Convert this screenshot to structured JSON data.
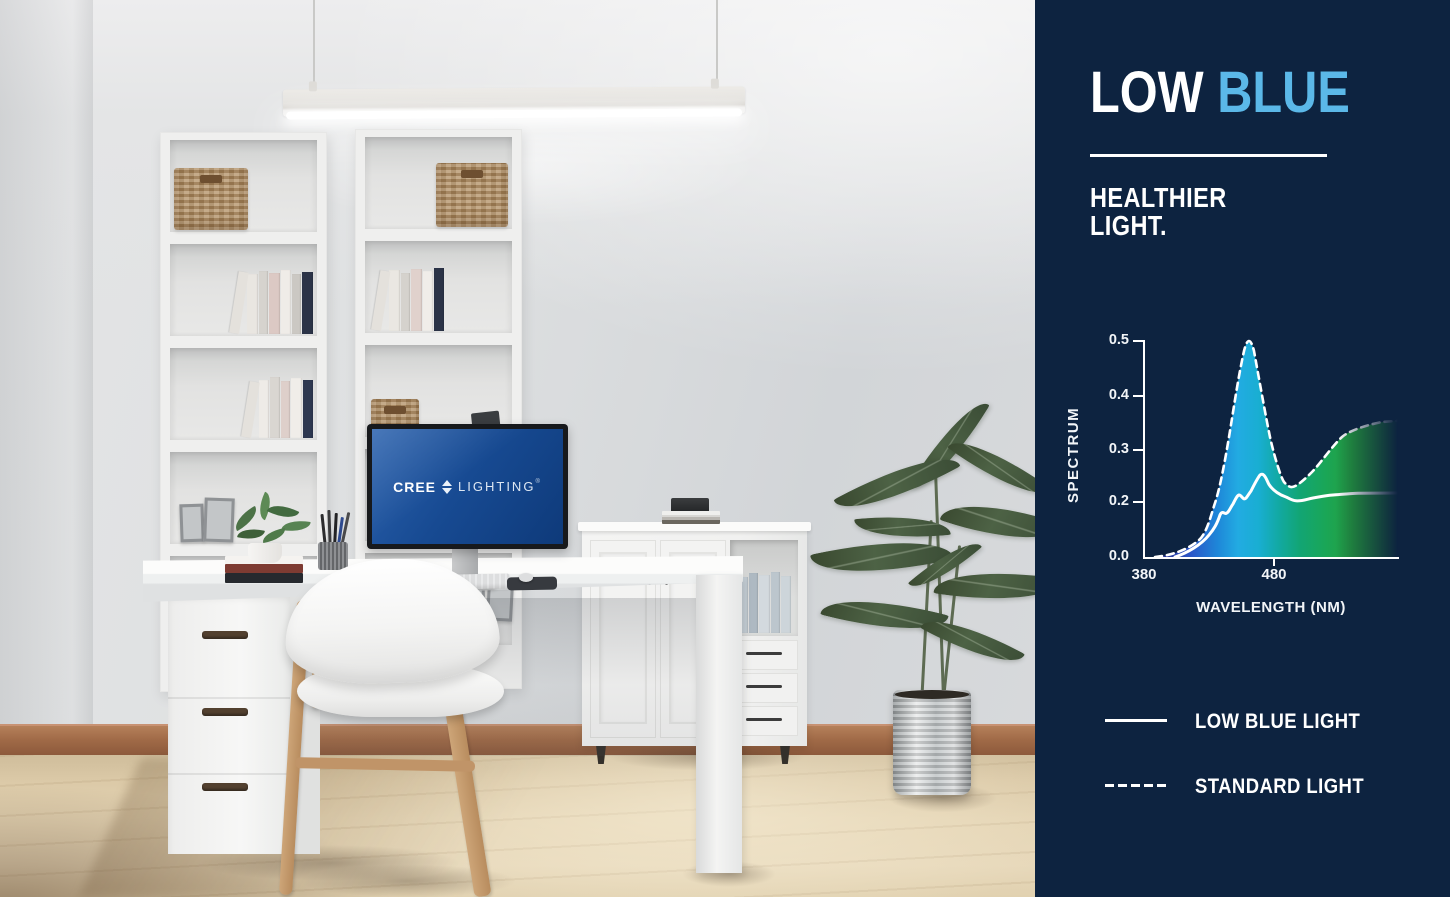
{
  "panel": {
    "bg_color": "#0d2340",
    "accent_color": "#5bb8e8",
    "title": {
      "word1": "LOW",
      "word2": "BLUE"
    },
    "subtitle_line1": "HEALTHIER",
    "subtitle_line2": "LIGHT.",
    "chart": {
      "y_axis_label": "SPECTRUM",
      "x_axis_label": "WAVELENGTH (NM)",
      "y_ticks": [
        "0.5",
        "0.4",
        "0.3",
        "0.2",
        "0.0"
      ],
      "x_ticks": [
        "380",
        "480"
      ],
      "legend": [
        {
          "label": "LOW BLUE LIGHT",
          "style": "solid"
        },
        {
          "label": "STANDARD LIGHT",
          "style": "dashed"
        }
      ]
    }
  },
  "scene": {
    "monitor_logo": {
      "brand": "CREE",
      "product": "LIGHTING",
      "tm": "®"
    }
  },
  "chart_data": {
    "type": "line",
    "title": "",
    "xlabel": "WAVELENGTH (NM)",
    "ylabel": "SPECTRUM",
    "xlim": [
      380,
      575
    ],
    "ylim": [
      0,
      0.5
    ],
    "x_tick_values": [
      380,
      480
    ],
    "y_tick_values": [
      0.0,
      0.2,
      0.3,
      0.4,
      0.5
    ],
    "grid": false,
    "legend_position": "below-left",
    "area_fill": "wavelength spectrum gradient under STANDARD LIGHT curve, fading out toward right edge",
    "spectrum_gradient": [
      "#1e2a78",
      "#2a3a9c",
      "#2b57c8",
      "#1e86d8",
      "#22abe2",
      "#19aed2",
      "#12a9a2",
      "#12a574",
      "#1aa657",
      "#259f3f",
      "#2d9b36"
    ],
    "series": [
      {
        "name": "STANDARD LIGHT",
        "style": "dashed",
        "color": "#ffffff",
        "points": [
          [
            393,
            0.0
          ],
          [
            405,
            0.01
          ],
          [
            418,
            0.04
          ],
          [
            428,
            0.09
          ],
          [
            435,
            0.14
          ],
          [
            441,
            0.21
          ],
          [
            447,
            0.3
          ],
          [
            452,
            0.39
          ],
          [
            456,
            0.46
          ],
          [
            459,
            0.5
          ],
          [
            462,
            0.46
          ],
          [
            466,
            0.37
          ],
          [
            471,
            0.28
          ],
          [
            476,
            0.24
          ],
          [
            483,
            0.225
          ],
          [
            492,
            0.23
          ],
          [
            500,
            0.25
          ],
          [
            512,
            0.28
          ],
          [
            525,
            0.31
          ],
          [
            540,
            0.33
          ],
          [
            555,
            0.34
          ],
          [
            572,
            0.345
          ]
        ]
      },
      {
        "name": "LOW BLUE LIGHT",
        "style": "solid",
        "color": "#ffffff",
        "points": [
          [
            400,
            0.0
          ],
          [
            415,
            0.02
          ],
          [
            425,
            0.05
          ],
          [
            432,
            0.09
          ],
          [
            437,
            0.13
          ],
          [
            441,
            0.16
          ],
          [
            444,
            0.17
          ],
          [
            448,
            0.165
          ],
          [
            452,
            0.19
          ],
          [
            456,
            0.21
          ],
          [
            459,
            0.205
          ],
          [
            463,
            0.22
          ],
          [
            468,
            0.26
          ],
          [
            472,
            0.225
          ],
          [
            478,
            0.21
          ],
          [
            485,
            0.205
          ],
          [
            495,
            0.21
          ],
          [
            510,
            0.215
          ],
          [
            530,
            0.22
          ],
          [
            555,
            0.22
          ],
          [
            572,
            0.22
          ]
        ]
      }
    ]
  }
}
